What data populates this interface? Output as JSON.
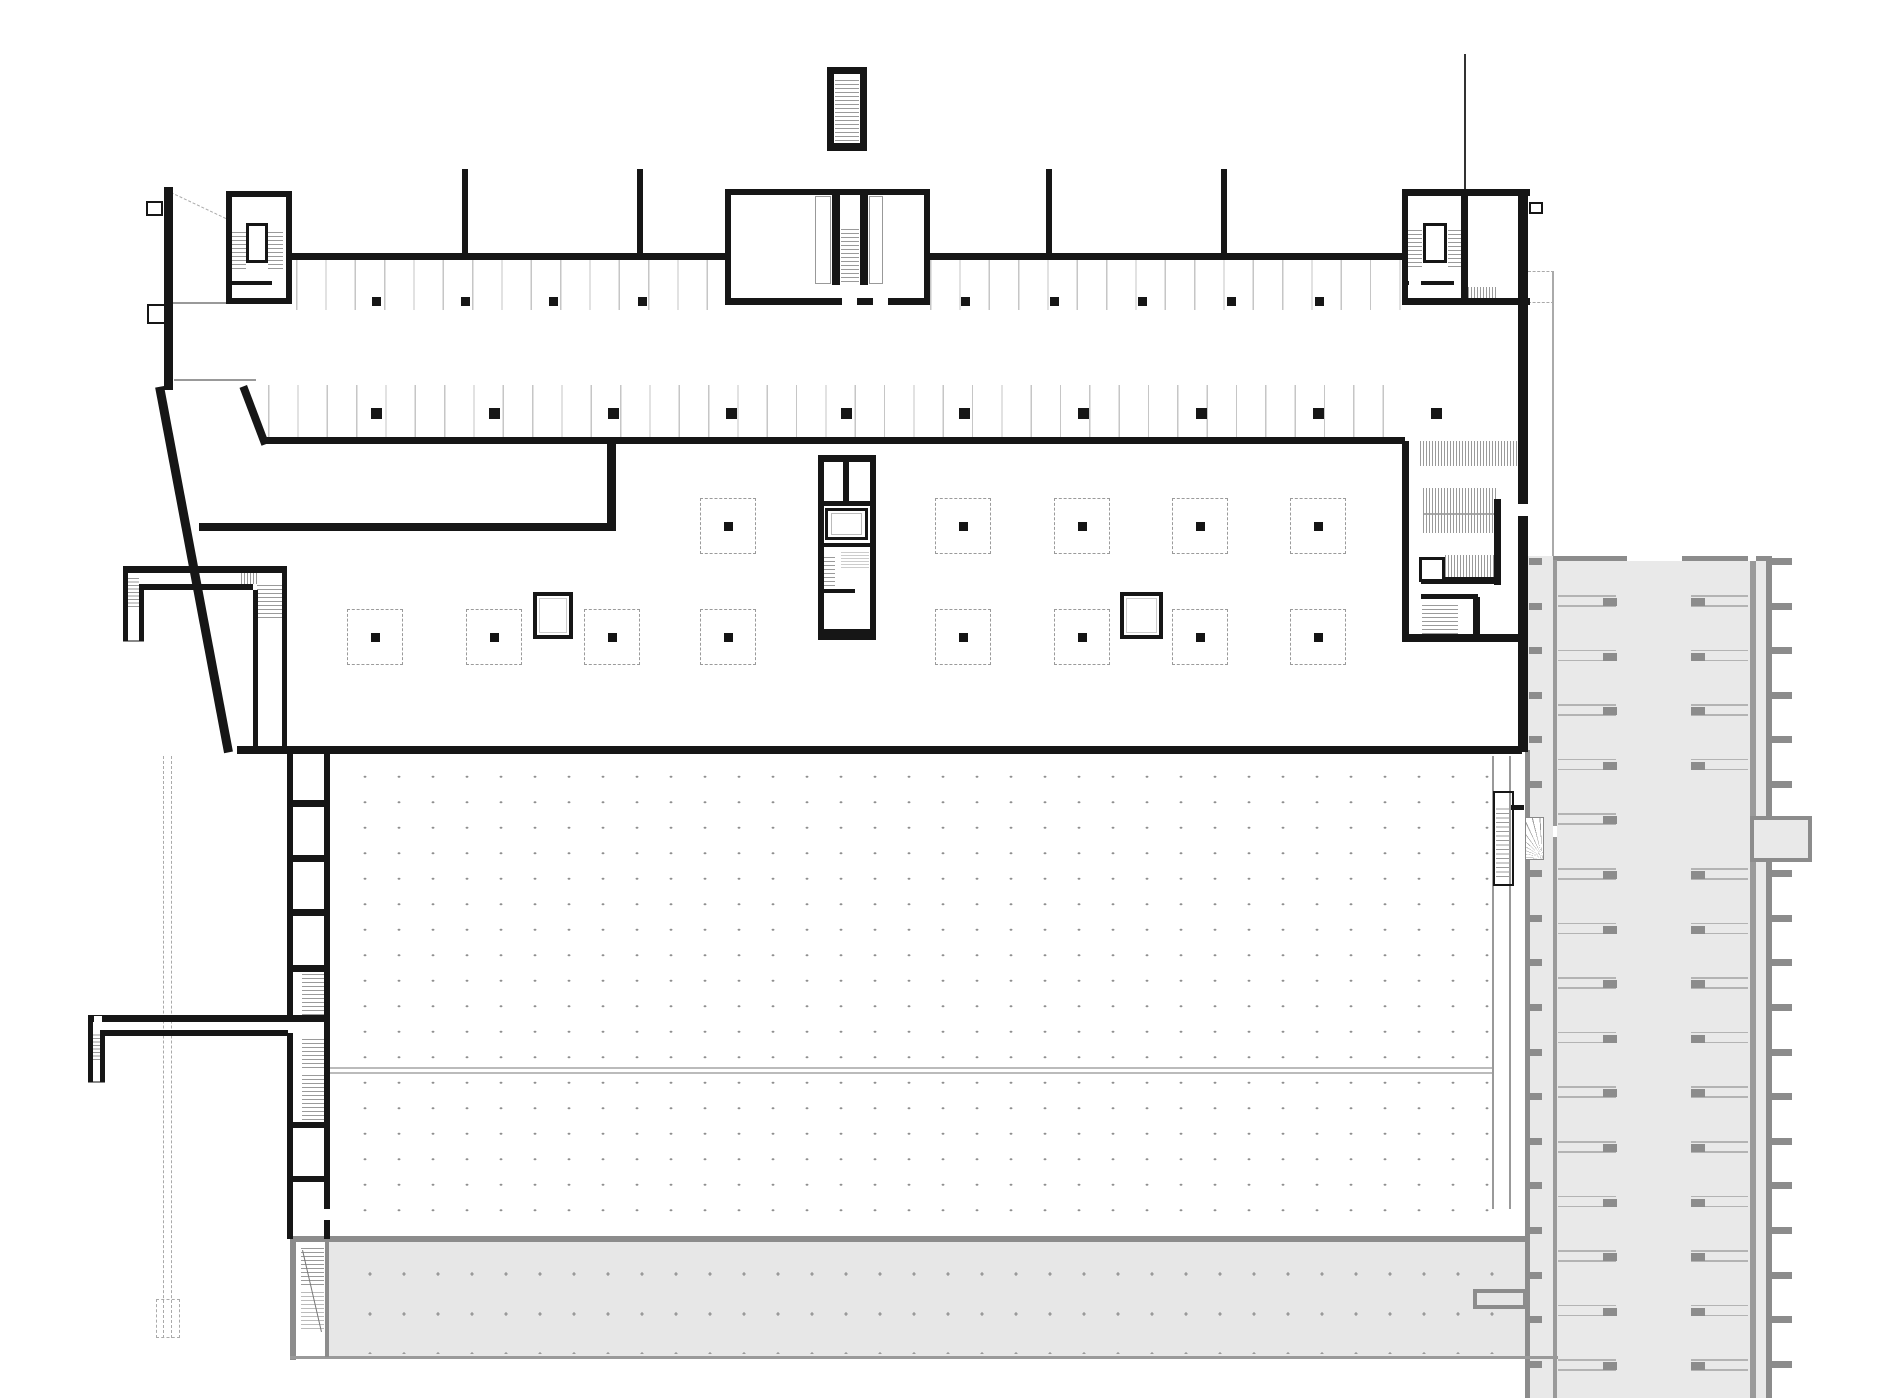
{
  "canvas": {
    "width": 1880,
    "height": 1398,
    "background": "#ffffff"
  },
  "palette": {
    "wall": "#161616",
    "thin": "#999999",
    "faint": "#bbbbbb",
    "stall_line": "#c6c6c6",
    "dot": "#8f8f8f",
    "gray_fill": "#e9e9e9",
    "band_fill": "#e7e7e7",
    "gray_wall": "#8c8c8c",
    "gray_mid": "#9a9a9a",
    "gray_line": "#b3b3b3"
  },
  "fills": [
    {
      "n": "neighbor-strip-floor",
      "x": 1525,
      "y": 556,
      "w": 247,
      "h": 842,
      "c": "#e9e9e9"
    },
    {
      "n": "bottom-band-floor",
      "x": 296,
      "y": 1241,
      "w": 1229,
      "h": 117,
      "c": "#e7e7e7"
    },
    {
      "n": "bottom-band-stair-slot",
      "x": 296,
      "y": 1242,
      "w": 29,
      "h": 114,
      "c": "#ffffff"
    },
    {
      "n": "strip-top-wall",
      "x": 1553,
      "y": 556,
      "w": 219,
      "h": 5,
      "c": "#8c8c8c"
    },
    {
      "n": "strip-left-wall",
      "x": 1525,
      "y": 750,
      "w": 5,
      "h": 648,
      "c": "#8c8c8c"
    },
    {
      "n": "strip-inner-wall",
      "x": 1553,
      "y": 560,
      "w": 4,
      "h": 838,
      "c": "#9a9a9a"
    },
    {
      "n": "strip-aisle-wall",
      "x": 1750,
      "y": 560,
      "w": 6,
      "h": 838,
      "c": "#9a9a9a"
    },
    {
      "n": "strip-right-wall",
      "x": 1766,
      "y": 556,
      "w": 6,
      "h": 842,
      "c": "#8c8c8c"
    },
    {
      "n": "strip-top-gap",
      "x": 1627,
      "y": 556,
      "w": 55,
      "h": 5,
      "c": "#ffffff"
    },
    {
      "n": "strip-top-gap",
      "x": 1748,
      "y": 556,
      "w": 8,
      "h": 5,
      "c": "#ffffff"
    },
    {
      "n": "strip-bump-bar",
      "x": 1764,
      "y": 834,
      "w": 48,
      "h": 9,
      "c": "#8c8c8c"
    },
    {
      "n": "band-top-wall",
      "x": 290,
      "y": 1236,
      "w": 1237,
      "h": 6,
      "c": "#8c8c8c"
    },
    {
      "n": "band-left-wall",
      "x": 290,
      "y": 1236,
      "w": 6,
      "h": 124,
      "c": "#8c8c8c"
    },
    {
      "n": "band-bottom-line",
      "x": 290,
      "y": 1356,
      "w": 1268,
      "h": 3,
      "c": "#9a9a9a"
    },
    {
      "n": "band-inner-wall",
      "x": 325,
      "y": 1241,
      "w": 4,
      "h": 116,
      "c": "#8c8c8c"
    }
  ],
  "strip": {
    "rows": {
      "x_left": 1558,
      "w_left": 58,
      "x_right": 1691,
      "w_right": 57,
      "y0": 595,
      "step": 54.6,
      "count": 15,
      "pair_gap": 10,
      "line_c": "#b3b3b3",
      "col_c": "#8c8c8c",
      "col_w": 14,
      "col_h": 8,
      "skip_right": [
        4
      ]
    },
    "tabs_left": {
      "x": 1529,
      "w": 13,
      "h": 7,
      "y0": 558,
      "step": 44.6,
      "count": 19,
      "c": "#8c8c8c"
    },
    "tabs_right": {
      "x": 1772,
      "w": 20,
      "h": 7,
      "y0": 558,
      "step": 44.6,
      "count": 19,
      "c": "#8c8c8c",
      "skip": [
        6
      ]
    },
    "bump": {
      "x": 1750,
      "y": 816,
      "w": 62,
      "h": 46,
      "border": 4,
      "c": "#8c8c8c",
      "fill": "#e9e9e9"
    }
  },
  "dots": [
    {
      "n": "hall-column-dot-grid",
      "x": 340,
      "y": 756,
      "w": 1150,
      "h": 474,
      "sx": 34,
      "sy": 25.5,
      "r": 1.3,
      "c": "#8f8f8f"
    },
    {
      "n": "band-dot-grid",
      "x": 345,
      "y": 1246,
      "w": 1150,
      "h": 108,
      "sx": 34,
      "sy": 40,
      "r": 1.4,
      "c": "#9a9a9a"
    }
  ],
  "dashes": [
    {
      "n": "hidden-edge",
      "x": 163,
      "y": 756,
      "h": 582
    },
    {
      "n": "hidden-edge",
      "x": 171,
      "y": 756,
      "h": 582
    }
  ],
  "dash_boxes": [
    {
      "n": "hidden-pit",
      "x": 156,
      "y": 1299,
      "w": 24,
      "h": 39
    }
  ],
  "thin": [
    {
      "x": 172,
      "y": 302,
      "w": 54,
      "h": 2,
      "c": "#999999"
    },
    {
      "x": 174,
      "y": 379,
      "w": 82,
      "h": 2,
      "c": "#999999"
    },
    {
      "x": 330,
      "y": 1067,
      "w": 1164,
      "h": 2,
      "c": "#bbbbbb"
    },
    {
      "x": 330,
      "y": 1072,
      "w": 1164,
      "h": 2,
      "c": "#bbbbbb"
    },
    {
      "x": 1492,
      "y": 756,
      "w": 2,
      "h": 453,
      "c": "#999999"
    },
    {
      "x": 1509,
      "y": 756,
      "w": 2,
      "h": 453,
      "c": "#999999"
    },
    {
      "x": 1552,
      "y": 272,
      "w": 2,
      "h": 284,
      "c": "#aaaaaa"
    },
    {
      "x": 1423,
      "y": 513,
      "w": 74,
      "h": 2,
      "c": "#aaaaaa"
    },
    {
      "x": 123,
      "y": 640,
      "w": 21,
      "h": 2,
      "c": "#888888"
    },
    {
      "x": 88,
      "y": 1081,
      "w": 17,
      "h": 2,
      "c": "#888888"
    },
    {
      "x": 1464,
      "y": 54,
      "w": 2,
      "h": 135,
      "c": "#333333"
    }
  ],
  "dotted_h": [
    {
      "x": 1528,
      "y": 271,
      "w": 26
    },
    {
      "x": 1528,
      "y": 302,
      "w": 26
    }
  ],
  "stalls": [
    {
      "n": "parking-row-1-left",
      "x": 296,
      "y": 260,
      "w": 430,
      "h": 50
    },
    {
      "n": "parking-row-1-right",
      "x": 930,
      "y": 260,
      "w": 472,
      "h": 50
    },
    {
      "n": "parking-row-2",
      "x": 268,
      "y": 385,
      "w": 1137,
      "h": 52
    }
  ],
  "stall_step": 29.33,
  "hatches": [
    {
      "n": "stair-treads",
      "x": 231,
      "y": 229,
      "w": 15,
      "h": 40,
      "d": "h",
      "g": 4
    },
    {
      "n": "stair-treads",
      "x": 268,
      "y": 229,
      "w": 15,
      "h": 40,
      "d": "h",
      "g": 4
    },
    {
      "n": "stair-treads",
      "x": 835,
      "y": 77,
      "w": 24,
      "h": 64,
      "d": "h",
      "g": 4
    },
    {
      "n": "stair-treads",
      "x": 841,
      "y": 226,
      "w": 18,
      "h": 56,
      "d": "h",
      "g": 4
    },
    {
      "n": "stair-treads",
      "x": 1407,
      "y": 229,
      "w": 15,
      "h": 38,
      "d": "h",
      "g": 4
    },
    {
      "n": "stair-treads",
      "x": 1448,
      "y": 229,
      "w": 13,
      "h": 38,
      "d": "h",
      "g": 4
    },
    {
      "n": "vent-hatch",
      "x": 1468,
      "y": 287,
      "w": 28,
      "h": 12,
      "d": "v",
      "g": 3
    },
    {
      "n": "ramp-hatch",
      "x": 1420,
      "y": 441,
      "w": 98,
      "h": 25,
      "d": "v",
      "g": 3
    },
    {
      "n": "ramp-hatch",
      "x": 1423,
      "y": 488,
      "w": 74,
      "h": 45,
      "d": "v",
      "g": 3
    },
    {
      "n": "ramp-hatch",
      "x": 1445,
      "y": 555,
      "w": 52,
      "h": 25,
      "d": "v",
      "g": 3
    },
    {
      "n": "stair-treads",
      "x": 1422,
      "y": 602,
      "w": 36,
      "h": 32,
      "d": "h",
      "g": 4
    },
    {
      "n": "stair-treads",
      "x": 821,
      "y": 554,
      "w": 14,
      "h": 32,
      "d": "h",
      "g": 4
    },
    {
      "n": "stair-treads-hidden",
      "x": 841,
      "y": 551,
      "w": 28,
      "h": 17,
      "d": "h",
      "g": 3,
      "c": "#cccccc"
    },
    {
      "n": "stair-treads",
      "x": 302,
      "y": 972,
      "w": 23,
      "h": 43,
      "d": "h",
      "g": 4
    },
    {
      "n": "stair-treads",
      "x": 302,
      "y": 1038,
      "w": 23,
      "h": 30,
      "d": "h",
      "g": 4
    },
    {
      "n": "stair-treads",
      "x": 302,
      "y": 1074,
      "w": 23,
      "h": 46,
      "d": "h",
      "g": 4
    },
    {
      "n": "stair-treads",
      "x": 128,
      "y": 577,
      "w": 11,
      "h": 30,
      "d": "h",
      "g": 3.5
    },
    {
      "n": "stair-treads",
      "x": 241,
      "y": 573,
      "w": 16,
      "h": 11,
      "d": "v",
      "g": 3
    },
    {
      "n": "stair-treads",
      "x": 257,
      "y": 584,
      "w": 25,
      "h": 34,
      "d": "h",
      "g": 4
    },
    {
      "n": "stair-treads",
      "x": 93,
      "y": 1033,
      "w": 11,
      "h": 27,
      "d": "h",
      "g": 3.5
    },
    {
      "n": "stair-treads",
      "x": 1496,
      "y": 807,
      "w": 15,
      "h": 70,
      "d": "h",
      "g": 4.5
    },
    {
      "n": "stair-treads",
      "x": 301,
      "y": 1247,
      "w": 23,
      "h": 38,
      "d": "h",
      "g": 4
    },
    {
      "n": "stair-treads-hidden",
      "x": 301,
      "y": 1289,
      "w": 23,
      "h": 40,
      "d": "h",
      "g": 4,
      "c": "#bbbbbb"
    }
  ],
  "dashed_squares": {
    "size": 56,
    "dot": 9,
    "border_c": "#9b9b9b",
    "dot_c": "#141414",
    "row1": {
      "cy": 526,
      "centers": [
        728,
        963,
        1082,
        1200,
        1318
      ]
    },
    "row2": {
      "cy": 637,
      "centers": [
        375,
        494,
        612,
        728,
        963,
        1082,
        1200,
        1318
      ]
    }
  },
  "columns": [
    {
      "n": "row1-columns",
      "y": 297,
      "s": 9,
      "xs": [
        372,
        461,
        549,
        638,
        961,
        1050,
        1138,
        1227,
        1315
      ]
    },
    {
      "n": "row2-columns",
      "y": 408,
      "s": 11,
      "xs": [
        371,
        489,
        608,
        726,
        841,
        959,
        1078,
        1196,
        1313,
        1431
      ]
    }
  ],
  "lines": [
    {
      "n": "perimeter-diagonal-wall",
      "x1": 164,
      "y1": 386,
      "x2": 233,
      "y2": 752,
      "w": 9,
      "c": "#161616"
    },
    {
      "n": "ramp-edge-diagonal",
      "x1": 247,
      "y1": 385,
      "x2": 269,
      "y2": 443,
      "w": 8,
      "c": "#161616"
    },
    {
      "n": "stair-run-line",
      "x1": 303,
      "y1": 1250,
      "x2": 322,
      "y2": 1332,
      "w": 1,
      "c": "#777777"
    },
    {
      "n": "dashed-diagonal",
      "x1": 171,
      "y1": 192,
      "x2": 226,
      "y2": 218,
      "w": 1,
      "c": "#aaaaaa",
      "dash": true
    }
  ],
  "walls": [
    {
      "x": 164,
      "y": 187,
      "w": 9,
      "h": 203
    },
    {
      "x": 226,
      "y": 191,
      "w": 66,
      "h": 6
    },
    {
      "x": 226,
      "y": 298,
      "w": 66,
      "h": 6
    },
    {
      "x": 226,
      "y": 191,
      "w": 6,
      "h": 113
    },
    {
      "x": 286,
      "y": 191,
      "w": 6,
      "h": 113
    },
    {
      "x": 227,
      "y": 281,
      "w": 49,
      "h": 4
    },
    {
      "x": 292,
      "y": 253,
      "w": 434,
      "h": 7
    },
    {
      "x": 928,
      "y": 253,
      "w": 474,
      "h": 7
    },
    {
      "x": 462,
      "y": 169,
      "w": 6,
      "h": 87
    },
    {
      "x": 637,
      "y": 169,
      "w": 6,
      "h": 87
    },
    {
      "x": 1046,
      "y": 169,
      "w": 6,
      "h": 87
    },
    {
      "x": 1221,
      "y": 169,
      "w": 6,
      "h": 87
    },
    {
      "x": 827,
      "y": 67,
      "w": 40,
      "h": 7
    },
    {
      "x": 827,
      "y": 143,
      "w": 40,
      "h": 8
    },
    {
      "x": 827,
      "y": 67,
      "w": 7,
      "h": 84
    },
    {
      "x": 860,
      "y": 67,
      "w": 7,
      "h": 84
    },
    {
      "x": 725,
      "y": 189,
      "w": 205,
      "h": 6
    },
    {
      "x": 725,
      "y": 298,
      "w": 205,
      "h": 7
    },
    {
      "x": 725,
      "y": 189,
      "w": 6,
      "h": 116
    },
    {
      "x": 924,
      "y": 189,
      "w": 6,
      "h": 116
    },
    {
      "x": 832,
      "y": 195,
      "w": 8,
      "h": 90
    },
    {
      "x": 860,
      "y": 195,
      "w": 8,
      "h": 90
    },
    {
      "x": 1402,
      "y": 189,
      "w": 128,
      "h": 7
    },
    {
      "x": 1402,
      "y": 298,
      "w": 128,
      "h": 7
    },
    {
      "x": 1402,
      "y": 189,
      "w": 6,
      "h": 116
    },
    {
      "x": 1461,
      "y": 189,
      "w": 7,
      "h": 116
    },
    {
      "x": 1403,
      "y": 281,
      "w": 51,
      "h": 4
    },
    {
      "x": 1518,
      "y": 189,
      "w": 10,
      "h": 563
    },
    {
      "x": 1402,
      "y": 441,
      "w": 7,
      "h": 201
    },
    {
      "x": 1402,
      "y": 634,
      "w": 126,
      "h": 8
    },
    {
      "x": 1494,
      "y": 499,
      "w": 7,
      "h": 86
    },
    {
      "x": 1421,
      "y": 577,
      "w": 76,
      "h": 7
    },
    {
      "x": 1421,
      "y": 594,
      "w": 57,
      "h": 5
    },
    {
      "x": 1473,
      "y": 597,
      "w": 7,
      "h": 40
    },
    {
      "x": 265,
      "y": 437,
      "w": 1140,
      "h": 7
    },
    {
      "x": 607,
      "y": 443,
      "w": 9,
      "h": 88
    },
    {
      "x": 199,
      "y": 523,
      "w": 415,
      "h": 8
    },
    {
      "x": 818,
      "y": 455,
      "w": 58,
      "h": 7
    },
    {
      "x": 818,
      "y": 629,
      "w": 58,
      "h": 11
    },
    {
      "x": 818,
      "y": 455,
      "w": 6,
      "h": 185
    },
    {
      "x": 870,
      "y": 455,
      "w": 6,
      "h": 185
    },
    {
      "x": 843,
      "y": 460,
      "w": 6,
      "h": 44
    },
    {
      "x": 823,
      "y": 501,
      "w": 47,
      "h": 5
    },
    {
      "x": 823,
      "y": 543,
      "w": 47,
      "h": 4
    },
    {
      "x": 823,
      "y": 589,
      "w": 47,
      "h": 4
    },
    {
      "x": 237,
      "y": 746,
      "w": 1285,
      "h": 8
    },
    {
      "x": 287,
      "y": 746,
      "w": 6,
      "h": 276
    },
    {
      "x": 287,
      "y": 1033,
      "w": 6,
      "h": 206
    },
    {
      "x": 324,
      "y": 746,
      "w": 6,
      "h": 463
    },
    {
      "x": 324,
      "y": 1220,
      "w": 6,
      "h": 19
    },
    {
      "x": 287,
      "y": 800,
      "w": 43,
      "h": 7
    },
    {
      "x": 287,
      "y": 855,
      "w": 43,
      "h": 7
    },
    {
      "x": 287,
      "y": 909,
      "w": 43,
      "h": 7
    },
    {
      "x": 287,
      "y": 965,
      "w": 43,
      "h": 7
    },
    {
      "x": 287,
      "y": 1015,
      "w": 43,
      "h": 7
    },
    {
      "x": 287,
      "y": 1122,
      "w": 43,
      "h": 6
    },
    {
      "x": 287,
      "y": 1176,
      "w": 43,
      "h": 6
    },
    {
      "x": 123,
      "y": 566,
      "w": 164,
      "h": 7
    },
    {
      "x": 139,
      "y": 584,
      "w": 114,
      "h": 6
    },
    {
      "x": 123,
      "y": 573,
      "w": 5,
      "h": 68
    },
    {
      "x": 139,
      "y": 590,
      "w": 5,
      "h": 51
    },
    {
      "x": 253,
      "y": 590,
      "w": 5,
      "h": 158
    },
    {
      "x": 282,
      "y": 573,
      "w": 5,
      "h": 175
    },
    {
      "x": 88,
      "y": 1015,
      "w": 200,
      "h": 7
    },
    {
      "x": 105,
      "y": 1030,
      "w": 183,
      "h": 6
    },
    {
      "x": 88,
      "y": 1015,
      "w": 5,
      "h": 67
    },
    {
      "x": 100,
      "y": 1030,
      "w": 5,
      "h": 52
    },
    {
      "x": 1511,
      "y": 805,
      "w": 13,
      "h": 5
    }
  ],
  "whites": [
    {
      "x": 842,
      "y": 298,
      "w": 15,
      "h": 7
    },
    {
      "x": 873,
      "y": 298,
      "w": 15,
      "h": 7
    },
    {
      "x": 1409,
      "y": 281,
      "w": 12,
      "h": 4
    },
    {
      "x": 1518,
      "y": 504,
      "w": 10,
      "h": 12
    },
    {
      "x": 855,
      "y": 589,
      "w": 15,
      "h": 4
    },
    {
      "x": 94,
      "y": 1016,
      "w": 8,
      "h": 6
    },
    {
      "x": 272,
      "y": 281,
      "w": 12,
      "h": 4
    },
    {
      "x": 1553,
      "y": 826,
      "w": 4,
      "h": 11
    }
  ],
  "boxes": [
    {
      "n": "window-tab",
      "x": 146,
      "y": 201,
      "w": 17,
      "h": 15,
      "b": 2,
      "c": "#161616",
      "fill": "#ffffff"
    },
    {
      "n": "window-tab",
      "x": 147,
      "y": 304,
      "w": 19,
      "h": 20,
      "b": 2,
      "c": "#161616",
      "fill": "#ffffff"
    },
    {
      "n": "elevator-cab",
      "x": 246,
      "y": 223,
      "w": 22,
      "h": 40,
      "b": 3,
      "c": "#161616",
      "fill": "#ffffff"
    },
    {
      "n": "elevator-cab",
      "x": 1423,
      "y": 223,
      "w": 24,
      "h": 40,
      "b": 3,
      "c": "#161616",
      "fill": "#ffffff"
    },
    {
      "n": "shaft-liner",
      "x": 815,
      "y": 196,
      "w": 16,
      "h": 88,
      "b": 1,
      "c": "#999999",
      "fill": "none"
    },
    {
      "n": "shaft-liner",
      "x": 869,
      "y": 196,
      "w": 14,
      "h": 88,
      "b": 1,
      "c": "#999999",
      "fill": "none"
    },
    {
      "n": "door-tab",
      "x": 1529,
      "y": 202,
      "w": 14,
      "h": 12,
      "b": 2,
      "c": "#161616",
      "fill": "#ffffff"
    },
    {
      "n": "elevator-cab",
      "x": 1419,
      "y": 557,
      "w": 26,
      "h": 25,
      "b": 3,
      "c": "#161616",
      "fill": "#ffffff"
    },
    {
      "n": "elevator-cab",
      "x": 825,
      "y": 508,
      "w": 43,
      "h": 32,
      "b": 3,
      "c": "#161616",
      "fill": "#ffffff"
    },
    {
      "n": "cab-liner",
      "x": 831,
      "y": 513,
      "w": 31,
      "h": 22,
      "b": 1,
      "c": "#bbbbbb",
      "fill": "none"
    },
    {
      "n": "structural-column",
      "x": 533,
      "y": 592,
      "w": 40,
      "h": 47,
      "b": 4,
      "c": "#161616",
      "fill": "#ffffff"
    },
    {
      "n": "column-liner",
      "x": 539,
      "y": 598,
      "w": 28,
      "h": 35,
      "b": 1,
      "c": "#cccccc",
      "fill": "none"
    },
    {
      "n": "structural-column",
      "x": 1120,
      "y": 592,
      "w": 43,
      "h": 47,
      "b": 4,
      "c": "#161616",
      "fill": "#ffffff"
    },
    {
      "n": "column-liner",
      "x": 1126,
      "y": 598,
      "w": 31,
      "h": 35,
      "b": 1,
      "c": "#cccccc",
      "fill": "none"
    },
    {
      "n": "hall-side-stair",
      "x": 1493,
      "y": 791,
      "w": 21,
      "h": 95,
      "b": 2,
      "c": "#161616",
      "fill": "none"
    },
    {
      "n": "band-room",
      "x": 1473,
      "y": 1289,
      "w": 54,
      "h": 20,
      "b": 4,
      "c": "#8c8c8c",
      "fill": "#e7e7e7"
    }
  ],
  "fan_stair": {
    "x": 1525,
    "y": 817,
    "w": 19,
    "h": 43
  }
}
